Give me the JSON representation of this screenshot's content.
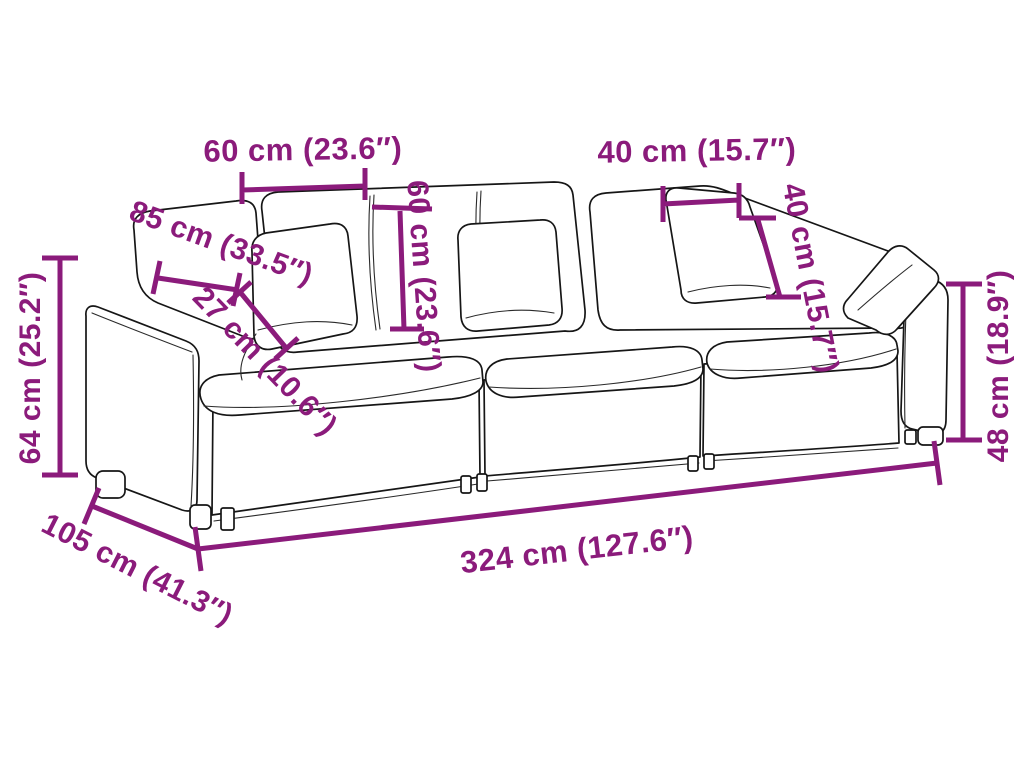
{
  "meta": {
    "description": "Sofa dimension diagram, 3-seater modular sofa line drawing with measurements",
    "background_color": "#ffffff",
    "accent_color": "#8B1B7B",
    "outline_color": "#161616"
  },
  "diagram": {
    "subject": "three-seat modular sofa with cushions",
    "dimensions": [
      {
        "id": "backrest-cushion-width",
        "label": "60 cm (23.6″)"
      },
      {
        "id": "pillow-width",
        "label": "40 cm (15.7″)"
      },
      {
        "id": "seat-depth-diagonal",
        "label": "85 cm (33.5″)"
      },
      {
        "id": "pillow-thickness",
        "label": "27 cm (10.6″)"
      },
      {
        "id": "backrest-cushion-height",
        "label": "60 cm (23.6″)"
      },
      {
        "id": "pillow-height",
        "label": "40 cm (15.7″)"
      },
      {
        "id": "overall-height-left",
        "label": "64 cm (25.2″)"
      },
      {
        "id": "arm-height-right",
        "label": "48 cm (18.9″)"
      },
      {
        "id": "overall-width",
        "label": "324 cm (127.6″)"
      },
      {
        "id": "overall-depth",
        "label": "105 cm (41.3″)"
      }
    ]
  }
}
